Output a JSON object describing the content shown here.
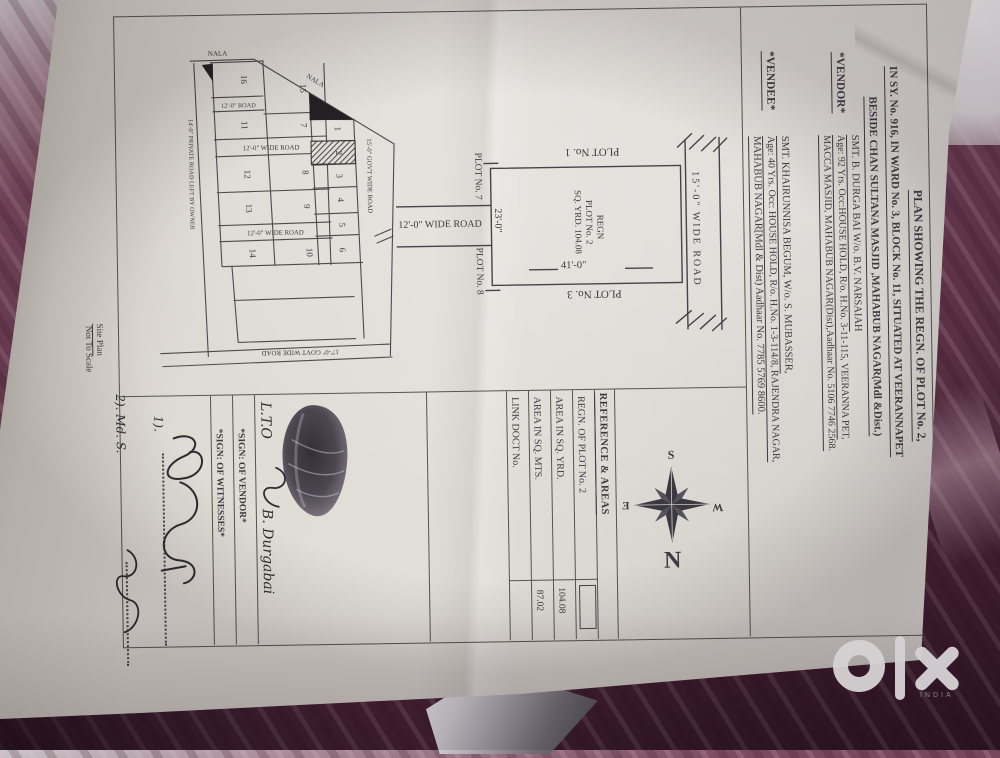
{
  "photo": {
    "watermark_country": "INDIA",
    "fabric_color": "#6b3c52",
    "paper_color": "#dedbd4"
  },
  "title": {
    "line1": "PLAN SHOWING THE REGN. OF PLOT No. 2,",
    "line2": "IN SY. No. 916, IN WARD No. 3, BLOCK No. 11, SITUATED AT VEERANNAPET",
    "line3": "BESIDE CHAN SULTANA MASJID ,MAHABUB NAGAR(Mdl &Dist.)"
  },
  "vendor": {
    "label": "*VENDOR*",
    "line1": "SMT. B. DURGA BAI W/o. B.V. NARSAIAH",
    "line2": "Age: 92 Yrs. Occ:HOUSE HOLD, R/o. H.No. 3-11-115, VEERANNA PET,",
    "line3": "MACCA MASJID, MAHABUB NAGAR(Dist),Aadhaar No. 5106 7746 2568."
  },
  "vendee": {
    "label": "*VENDEE*",
    "line1": "SMT. KHAIRUNNISA BEGUM, W/o. S. MUBASSER,",
    "line2": "Age: 40 Yrs. Occ: HOUSE HOLD, R/o. H.No. 1-3-114/8, RAJENDRA NAGAR,",
    "line3": "MAHABUB NAGAR[Mdl & Dist) Aadhaar No. 7785 5769 8600."
  },
  "site_plan": {
    "nala1": "NALA",
    "nala2": "NALA",
    "road_16_11": "12'-0\" ROAD",
    "road_mid1": "12'-0\" WIDE ROAD",
    "road_mid2": "12'-0\" WIDE ROAD",
    "road_bottom": "17'-0\" GOVT WIDE ROAD",
    "road_right": "15'-0\" GOVT WIDE ROAD",
    "road_left": "14'-0\" PRIVATE ROAD LEFT BY OWNER",
    "plots": {
      "n1": "1",
      "n2": "2",
      "n3": "3",
      "n4": "4",
      "n5": "5",
      "n6": "6",
      "n7": "7",
      "n8": "8",
      "n9": "9",
      "n10": "10",
      "n11": "11",
      "n12": "12",
      "n13": "13",
      "n14": "14",
      "n15": "15",
      "n16": "16"
    },
    "note1": "Site Plan",
    "note2": "Not To Scale"
  },
  "plot_diagram": {
    "plot_top": "PLOT No. 1",
    "plot_bottom": "PLOT No. 3",
    "plot_left_top": "PLOT No. 7",
    "plot_left_bottom": "PLOT No. 8",
    "road_right": "15'-0\" WIDE ROAD",
    "road_left": "12'-0\" WIDE ROAD",
    "dim_width": "41'-0\"",
    "dim_height": "23'-0\"",
    "center1": "REGN",
    "center2": "PLOT No. 2",
    "center3": "SQ. YRD. 104.08"
  },
  "compass": {
    "top": "S",
    "bottom": "N",
    "left": "Ǝ",
    "right": "W"
  },
  "reference": {
    "header": "REFERENCE & AREAS",
    "row1_label": "REGN. OF PLOT No. 2",
    "row2_label": "AREA IN SQ. YRD.",
    "row2_value": "104.08",
    "row3_label": "AREA IN SQ. MTS.",
    "row3_value": "87.02",
    "row4_label": "LINK DOCT No."
  },
  "signatures": {
    "sign_vendor_label": "*SIGN: OF VENDOR*",
    "sign_witness_label": "*SIGN: OF WITNESSES*",
    "vendor_hw1": "L.T.O",
    "vendor_hw2": "B. Durgabai",
    "witness1": "1).",
    "witness2": "2). Md. S."
  }
}
